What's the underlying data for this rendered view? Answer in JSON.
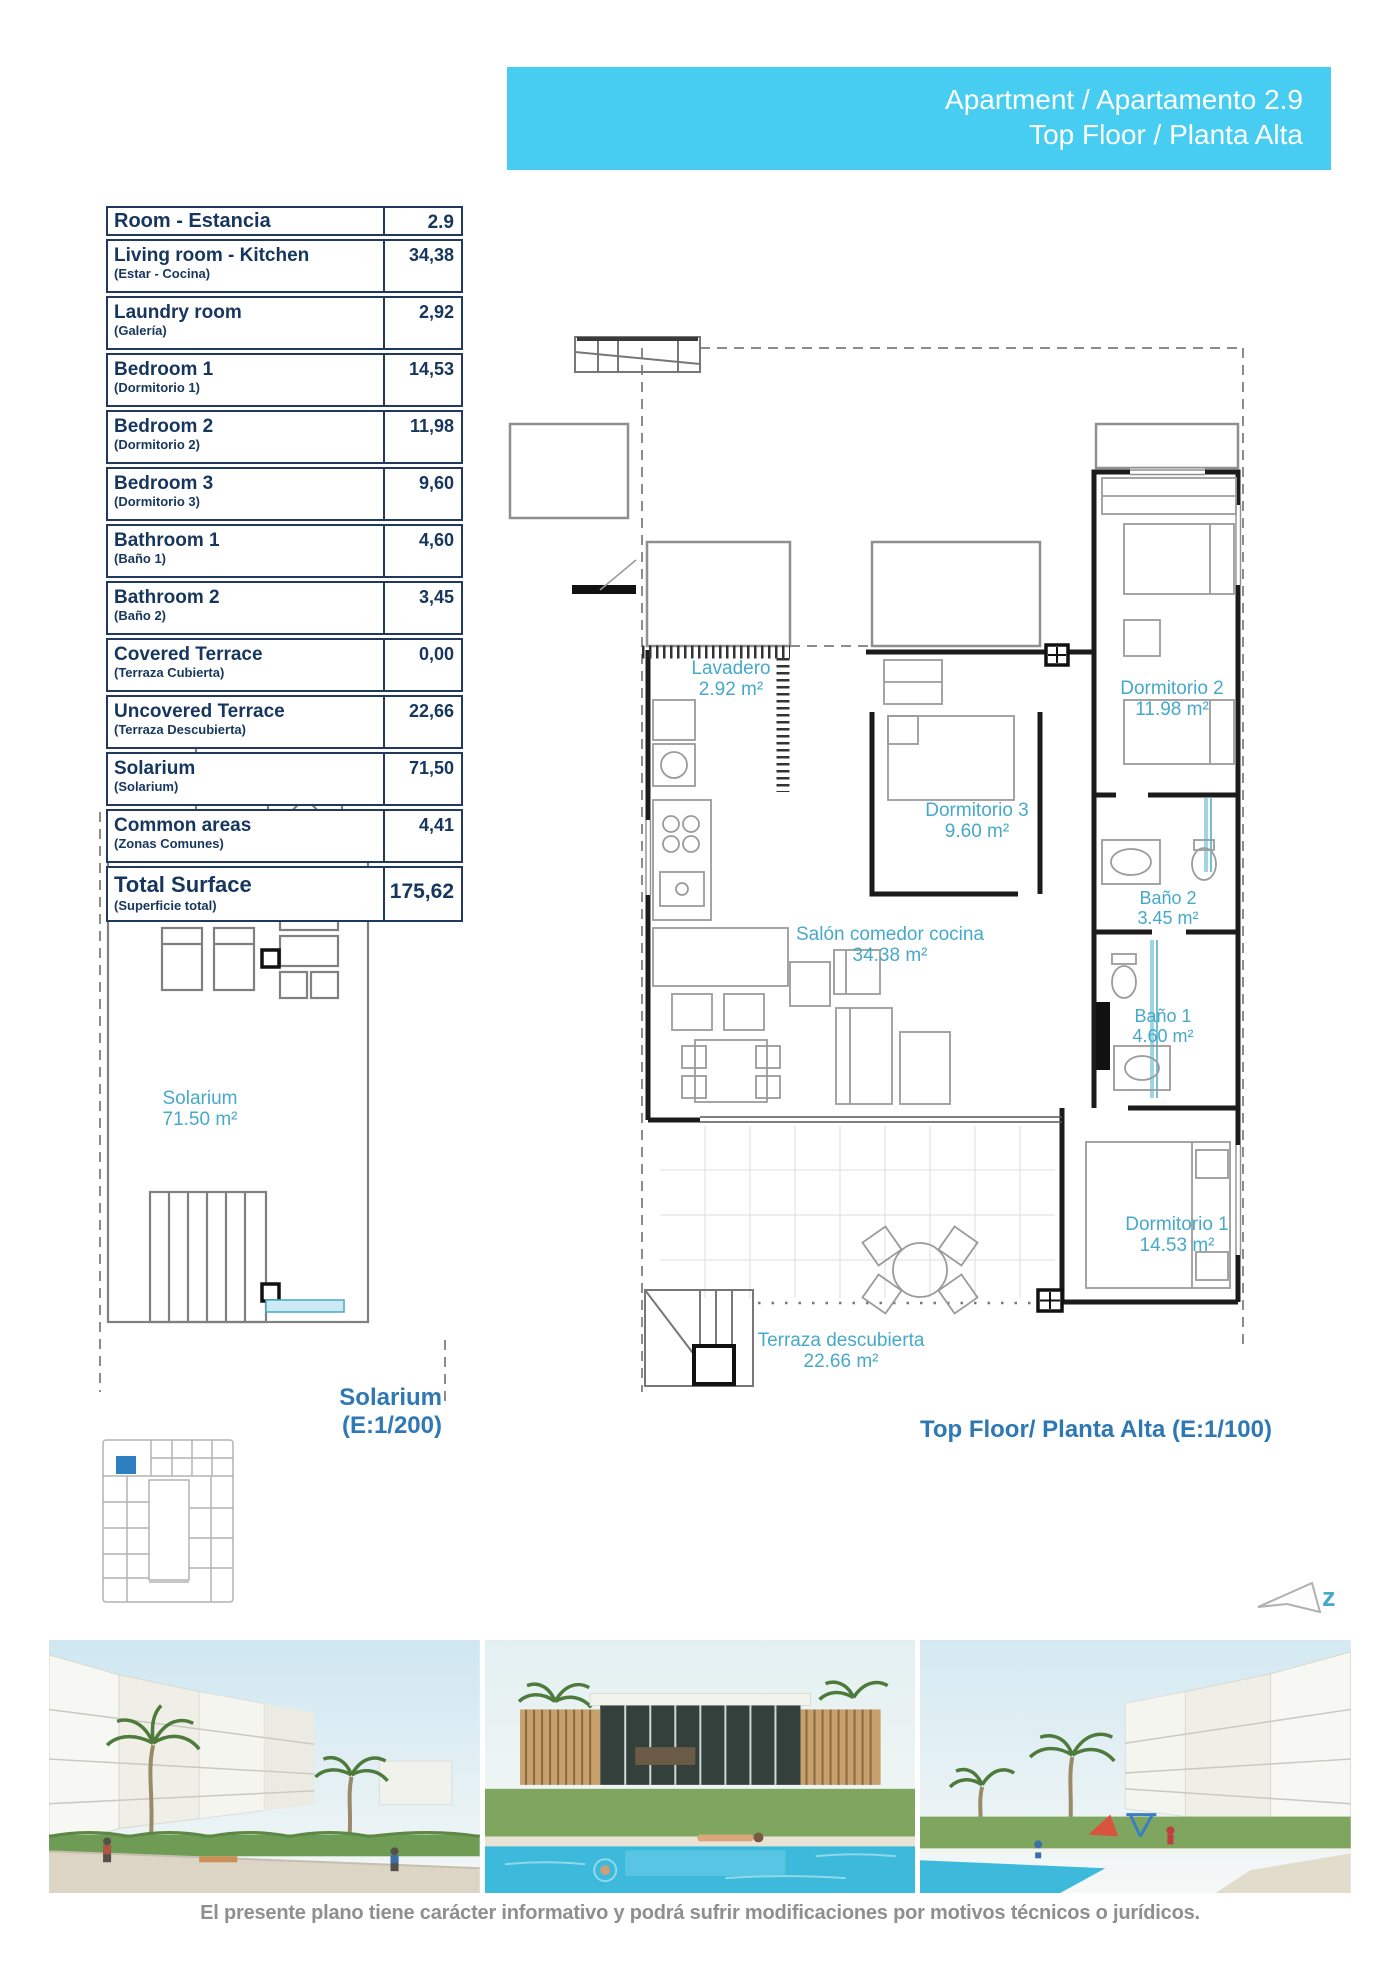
{
  "header": {
    "line1": "Apartment / Apartamento 2.9",
    "line2": "Top Floor / Planta Alta"
  },
  "surface_table": {
    "header": {
      "room": "Room - Estancia",
      "unit": "2.9"
    },
    "rows": [
      {
        "name": "Living room - Kitchen",
        "sub": "(Estar - Cocina)",
        "value": "34,38"
      },
      {
        "name": "Laundry room",
        "sub": "(Galería)",
        "value": "2,92"
      },
      {
        "name": "Bedroom 1",
        "sub": "(Dormitorio 1)",
        "value": "14,53"
      },
      {
        "name": "Bedroom 2",
        "sub": "(Dormitorio 2)",
        "value": "11,98"
      },
      {
        "name": "Bedroom 3",
        "sub": "(Dormitorio 3)",
        "value": "9,60"
      },
      {
        "name": "Bathroom 1",
        "sub": "(Baño 1)",
        "value": "4,60"
      },
      {
        "name": "Bathroom 2",
        "sub": "(Baño 2)",
        "value": "3,45"
      },
      {
        "name": "Covered Terrace",
        "sub": "(Terraza Cubierta)",
        "value": "0,00"
      },
      {
        "name": "Uncovered Terrace",
        "sub": "(Terraza Descubierta)",
        "value": "22,66"
      },
      {
        "name": "Solarium",
        "sub": "(Solarium)",
        "value": "71,50"
      },
      {
        "name": "Common areas",
        "sub": "(Zonas Comunes)",
        "value": "4,41"
      }
    ],
    "total": {
      "name": "Total Surface",
      "sub": "(Superficie total)",
      "value": "175,62"
    }
  },
  "floor_plan": {
    "caption": "Top Floor/ Planta Alta (E:1/100)",
    "rooms": [
      {
        "label": "Lavadero",
        "area": "2.92 m²"
      },
      {
        "label": "Dormitorio 2",
        "area": "11.98 m²"
      },
      {
        "label": "Dormitorio 3",
        "area": "9.60 m²"
      },
      {
        "label": "Baño 2",
        "area": "3.45 m²"
      },
      {
        "label": "Salón comedor cocina",
        "area": "34.38 m²"
      },
      {
        "label": "Baño 1",
        "area": "4.60 m²"
      },
      {
        "label": "Dormitorio 1",
        "area": "14.53 m²"
      },
      {
        "label": "Terraza descubierta",
        "area": "22.66 m²"
      }
    ]
  },
  "solarium_plan": {
    "room_label": "Solarium",
    "room_area": "71.50 m²",
    "caption_line1": "Solarium",
    "caption_line2": "(E:1/200)"
  },
  "compass": {
    "label": "z"
  },
  "footer": {
    "disclaimer": "El presente plano tiene carácter informativo y podrá sufrir modificaciones por motivos técnicos o jurídicos."
  },
  "colors": {
    "accent_cyan": "#47cdf1",
    "table_navy": "#17365d",
    "label_cyan": "#47a9c9",
    "caption_blue": "#2d78b5",
    "highlight_unit": "#2d7fc1"
  }
}
